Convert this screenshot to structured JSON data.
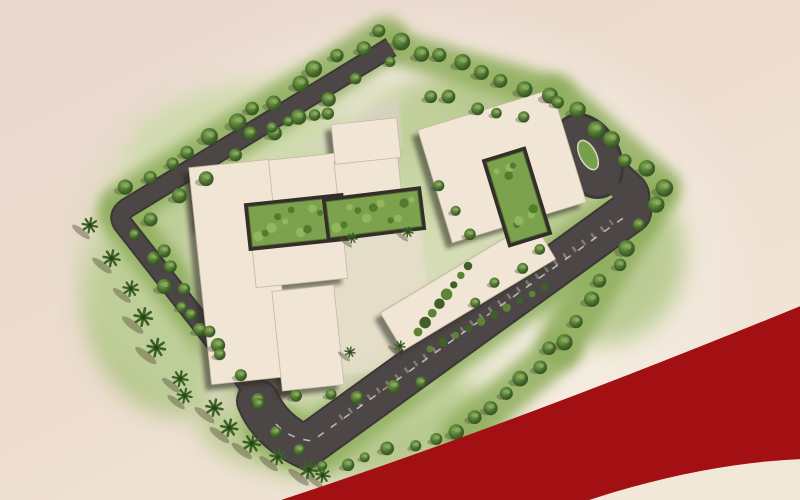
{
  "page": {
    "title": "Master Plan Aerial Site Render",
    "kind": "architectural site plan illustration (top-down artist rendering)",
    "visible_text": []
  },
  "colors": {
    "background_top": "#e9d7cd",
    "background_mid": "#ecdccf",
    "background_bottom": "#f2e8da",
    "glow": "#f8f3e8",
    "grass_base": "#cdd9ab",
    "grass_mid": "#a9c17b",
    "grass_band": "#8fae5d",
    "grass_dark": "#7da24d",
    "tree_outer": "#3b5c26",
    "road_fill": "#4c4746",
    "road_edge": "#3c3837",
    "road_dash": "#d8d2c6",
    "paving": "#ded7c6",
    "plaza_dark": "#524c46",
    "building_fill": "#f1e5d5",
    "building_edge": "#c7b7a2",
    "building_shadow": "rgba(42,36,30,0.55)",
    "courtyard_green": "#7da24d",
    "hedge_dark": "#3f6128",
    "pool_light": "#5ecbd6",
    "pool_dark": "#2196ab",
    "pool_rim": "#f4ecdc",
    "island_green": "#76a14b",
    "ribbon_red": "#a31013"
  },
  "scene": {
    "elements": [
      "curved entry road tapering at top",
      "perimeter road around plot",
      "wide lower road with dashed center line and median hedge",
      "drop-off loop with oval green island",
      "small green traffic island on west road",
      "cream residential building blocks",
      "courtyard roof gardens",
      "turquoise swimming pool with loungers and pavilion",
      "tree-lined boundaries",
      "palm trees with long shadows",
      "red decorative ribbon across lower-right corner"
    ]
  }
}
